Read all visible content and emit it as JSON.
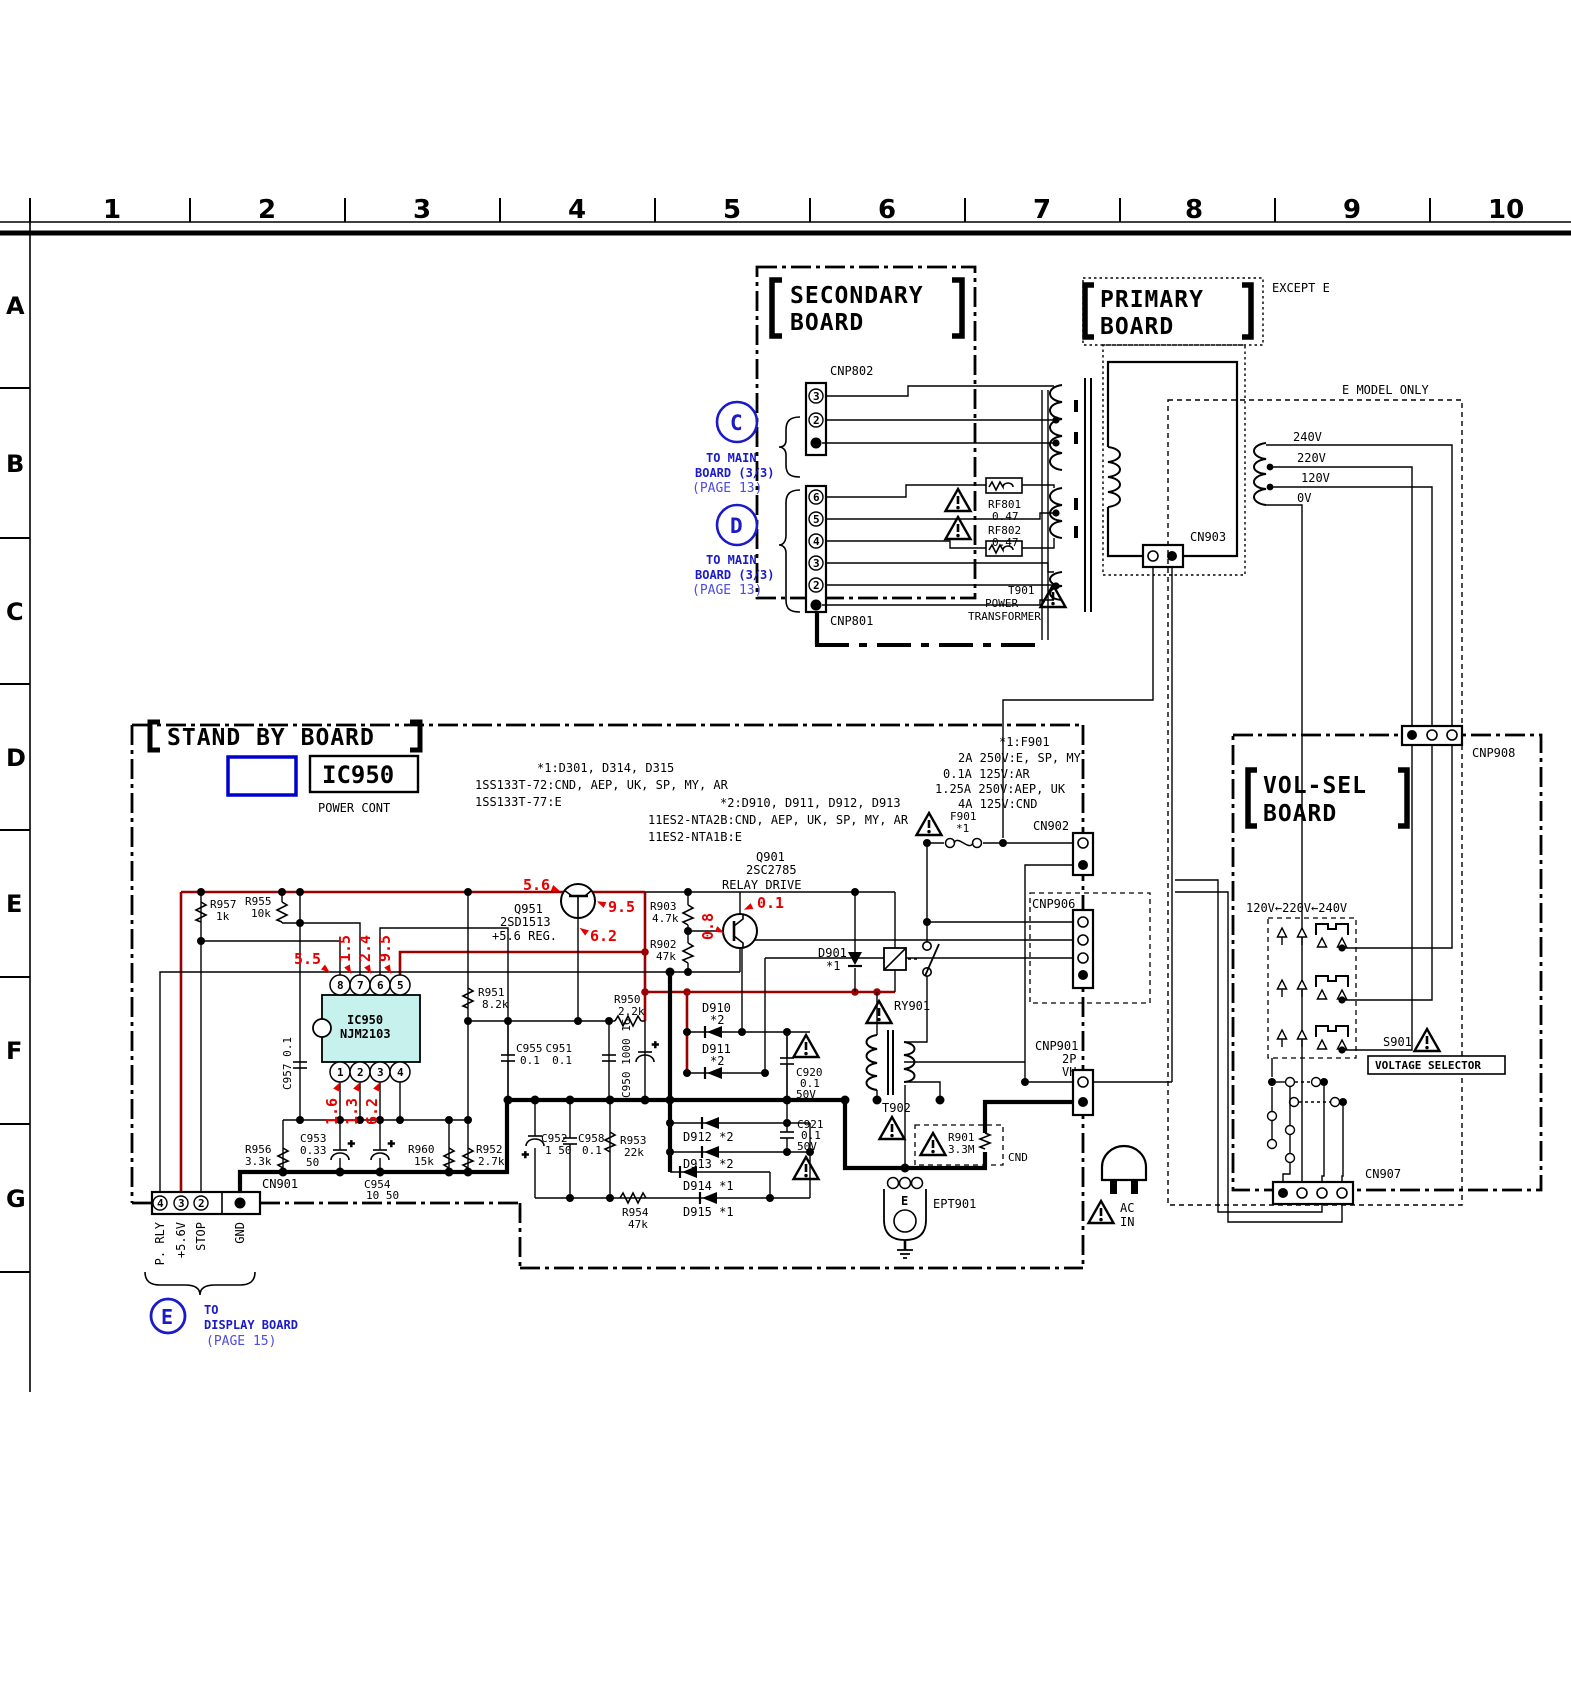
{
  "ruler": {
    "cols": [
      "1",
      "2",
      "3",
      "4",
      "5",
      "6",
      "7",
      "8",
      "9",
      "10"
    ],
    "rows": [
      "A",
      "B",
      "C",
      "D",
      "E",
      "F",
      "G"
    ]
  },
  "boards": {
    "secondary1": "SECONDARY",
    "secondary2": "BOARD",
    "primary1": "PRIMARY",
    "primary2": "BOARD",
    "standby": "STAND BY BOARD",
    "volsel1": "VOL-SEL",
    "volsel2": "BOARD"
  },
  "tags": {
    "except_e": "EXCEPT E",
    "e_model_only": "E MODEL ONLY"
  },
  "callouts": {
    "c": "C",
    "d": "D",
    "e": "E",
    "to_main": "TO MAIN",
    "board33": "BOARD (3/3)",
    "page13": "(PAGE 13)",
    "to": "TO",
    "display_board": "DISPLAY BOARD",
    "page15": "(PAGE 15)"
  },
  "connectors": {
    "cnp802": "CNP802",
    "cnp801": "CNP801",
    "cn903": "CN903",
    "cn902": "CN902",
    "cnp906": "CNP906",
    "cnp901": "CNP901",
    "cnp901_2p": "2P",
    "cnp901_vh": "VH",
    "cn901": "CN901",
    "cnp908": "CNP908",
    "cn907": "CN907"
  },
  "pins": {
    "cnp802": [
      "3",
      "2"
    ],
    "cnp801": [
      "6",
      "5",
      "4",
      "3",
      "2"
    ],
    "cn901": [
      "4",
      "3",
      "2"
    ],
    "ic_top": [
      "8",
      "7",
      "6",
      "5"
    ],
    "ic_bot": [
      "1",
      "2",
      "3",
      "4"
    ]
  },
  "signals": [
    "P. RLY",
    "+5.6V",
    "STOP",
    "GND"
  ],
  "taps": [
    "240V",
    "220V",
    "120V",
    "0V"
  ],
  "transformer": {
    "t901": "T901",
    "t901_l2": "POWER",
    "t901_l3": "TRANSFORMER",
    "t902": "T902"
  },
  "selector": {
    "s901": "S901",
    "label": "VOLTAGE SELECTOR",
    "range": "120V←220V←240V"
  },
  "notes": {
    "n1a": "*1:D301, D314, D315",
    "n1b": "1SS133T-72:CND, AEP, UK, SP, MY, AR",
    "n1c": "1SS133T-77:E",
    "n2a": "*2:D910, D911, D912, D913",
    "n2b": "11ES2-NTA2B:CND, AEP, UK, SP, MY, AR",
    "n2c": "11ES2-NTA1B:E",
    "f1": "*1:F901",
    "f2": "2A 250V:E, SP, MY",
    "f3": "0.1A 125V:AR",
    "f4": "1.25A 250V:AEP, UK",
    "f5": "4A 125V:CND"
  },
  "ic": {
    "box": "IC950",
    "sub": "POWER CONT",
    "chip1": "IC950",
    "chip2": "NJM2103"
  },
  "semi": {
    "q951": "Q951",
    "q951_type": "2SD1513",
    "q951_role": "+5.6 REG.",
    "q901": "Q901",
    "q901_type": "2SC2785",
    "q901_role": "RELAY DRIVE",
    "d901": "D901",
    "star1": "*1",
    "ry901": "RY901",
    "f901": "F901",
    "ept901": "EPT901",
    "e_mark": "E",
    "ac1": "AC",
    "ac2": "IN",
    "cnd": "CND"
  },
  "diodes": {
    "d910": "D910",
    "d911": "D911",
    "s2": "*2",
    "d912": "D912 *2",
    "d913": "D913 *2",
    "d914": "D914 *1",
    "d915": "D915 *1"
  },
  "parts": {
    "r957": "R957",
    "r957v": "1k",
    "r955": "R955",
    "r955v": "10k",
    "r951": "R951",
    "r951v": "8.2k",
    "r903": "R903",
    "r903v": "4.7k",
    "r902": "R902",
    "r902v": "47k",
    "r950": "R950",
    "r950v": "2.2k",
    "r956": "R956",
    "r956v": "3.3k",
    "r960": "R960",
    "r960v": "15k",
    "r952": "R952",
    "r952v": "2.7k",
    "r953": "R953",
    "r953v": "22k",
    "r954": "R954",
    "r954v": "47k",
    "r901": "R901",
    "r901v": "3.3M",
    "c957": "C957 0.1",
    "c955": "C955",
    "c955v": "0.1",
    "c951": "C951",
    "c951v": "0.1",
    "c950": "C950 1000 16",
    "c953a": "C953",
    "c953b": "0.33",
    "c953c": "50",
    "c954a": "C954",
    "c954b": "10 50",
    "c952a": "C952",
    "c952b": "1 50",
    "c958": "C958",
    "c958v": "0.1",
    "c920a": "C920",
    "c920b": "0.1",
    "c920c": "50V",
    "c921a": "C921",
    "c921b": "0.1",
    "c921c": "50V",
    "rf801": "RF801",
    "rf801v": "0.47",
    "rf802": "RF802",
    "rf802v": "0.47"
  },
  "meas": {
    "m1": "5.6",
    "m2": "9.5",
    "m3": "6.2",
    "m4": "5.5",
    "m5": "1.5",
    "m6": "2.4",
    "m7": "9.5",
    "m8": "1.6",
    "m9": "1.3",
    "m10": "6.2",
    "m11": "0.8",
    "m12": "0.1"
  },
  "colors": {
    "blue": "#1a1ac8",
    "page_blue": "#4d4de0",
    "red": "#e60000",
    "wire_red": "#9b0000",
    "chip": "#c6f1ec"
  }
}
